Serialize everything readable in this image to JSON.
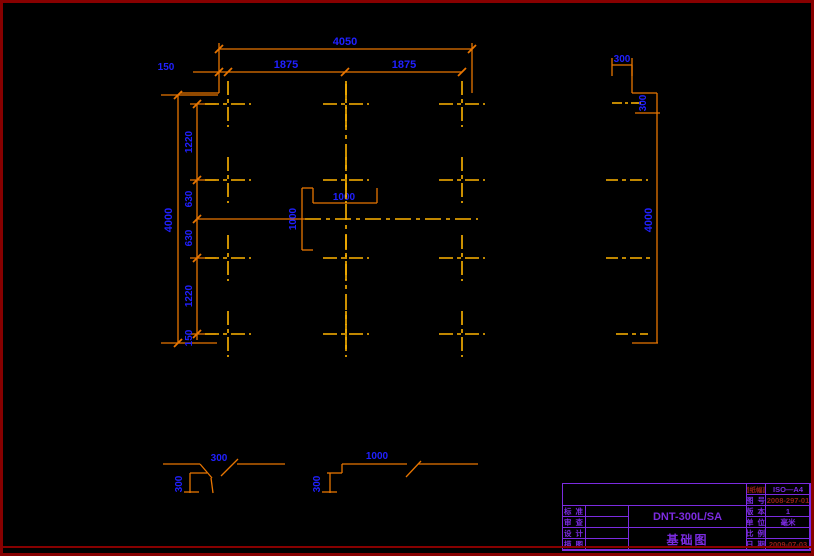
{
  "colors": {
    "background": "#000000",
    "frame_red": "#870000",
    "line_orange": "#E87500",
    "centerline_gold": "#FFB400",
    "dim_blue": "#2020FF",
    "tb_violet": "#7B2BE0",
    "tb_red": "#932015"
  },
  "plan": {
    "top": {
      "total": "4050",
      "segments": [
        "150",
        "1875",
        "1875"
      ]
    },
    "left": {
      "total": "4000",
      "segments": [
        "1220",
        "630",
        "630",
        "1220",
        "150"
      ]
    },
    "center": {
      "h": "1000",
      "v": "1000"
    }
  },
  "section": {
    "top_width": "300",
    "step": "300",
    "height": "4000"
  },
  "details": {
    "a": {
      "width": "300",
      "depth": "300"
    },
    "b": {
      "width": "1000",
      "depth": "300"
    }
  },
  "titleblock": {
    "model": "DNT-300L/SA",
    "title": "基础图",
    "left_rows": [
      {
        "label": "标 准"
      },
      {
        "label": "审 查"
      },
      {
        "label": "设 计"
      },
      {
        "label": "描 图"
      }
    ],
    "right_rows": [
      {
        "label": "图纸幅面",
        "value": "ISO—A4"
      },
      {
        "label": "图 号",
        "value": "2008-297-01"
      },
      {
        "label": "版 本",
        "value": "1"
      },
      {
        "label": "单 位",
        "value": "毫米"
      },
      {
        "label": "比 例",
        "value": ""
      },
      {
        "label": "日 期",
        "value": "2009-07-03"
      }
    ]
  }
}
